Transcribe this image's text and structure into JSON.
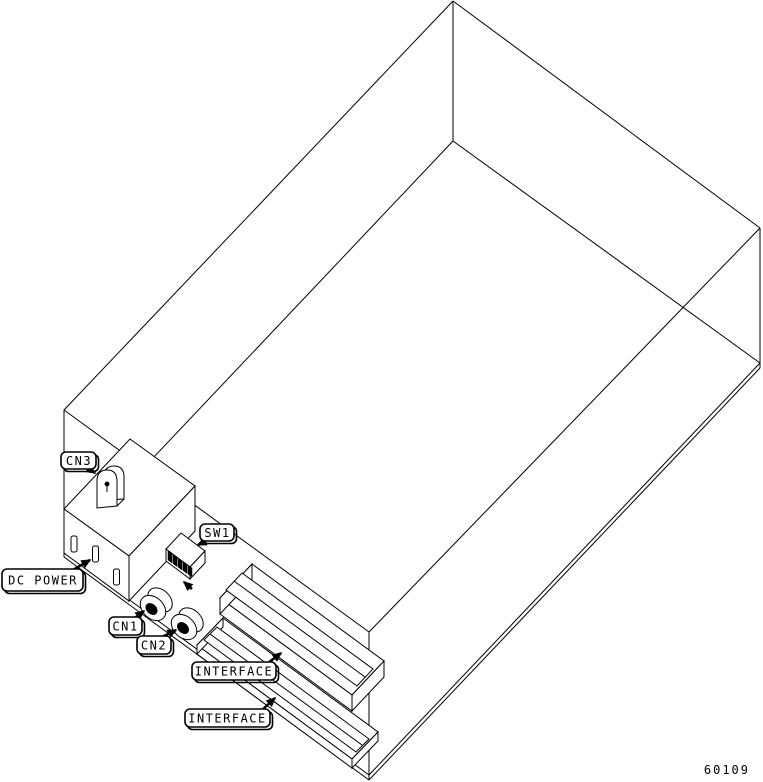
{
  "figure": {
    "number": "60109"
  },
  "callouts": {
    "cn3": {
      "text": "CN3"
    },
    "sw1": {
      "text": "SW1"
    },
    "dc_power": {
      "text": "DC POWER"
    },
    "cn1": {
      "text": "CN1"
    },
    "cn2": {
      "text": "CN2"
    },
    "interface_upper": {
      "text": "INTERFACE"
    },
    "interface_lower": {
      "text": "INTERFACE"
    }
  },
  "colors": {
    "line": "#000000",
    "background": "#ffffff"
  }
}
